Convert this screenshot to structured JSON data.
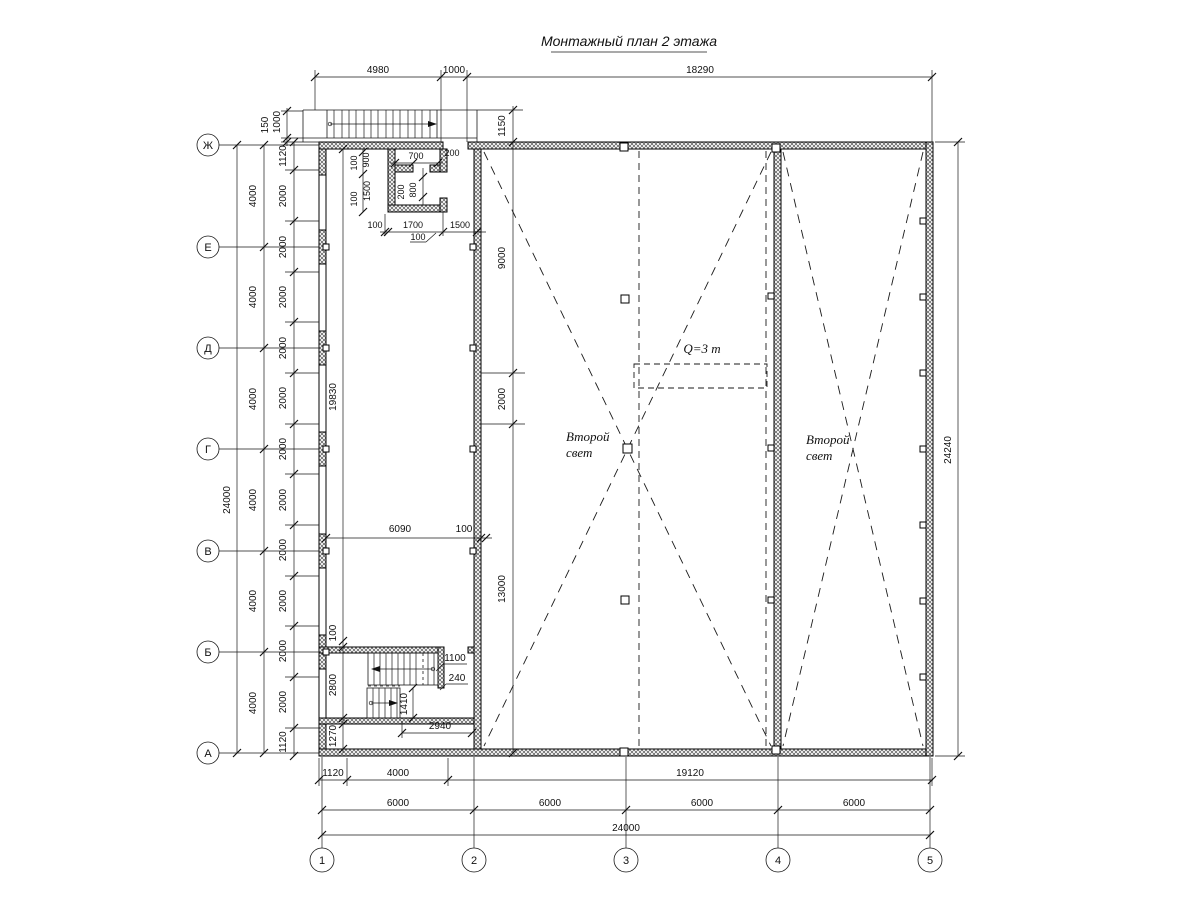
{
  "title": "Монтажный план 2 этажа",
  "grid": {
    "rows": [
      "Ж",
      "Е",
      "Д",
      "Г",
      "В",
      "Б",
      "А"
    ],
    "cols": [
      "1",
      "2",
      "3",
      "4",
      "5"
    ]
  },
  "dims": {
    "top": [
      "4980",
      "1000",
      "18290"
    ],
    "stair_top": {
      "gap": "150",
      "width": "1000"
    },
    "left": {
      "total": "24000",
      "bays": [
        "4000",
        "4000",
        "4000",
        "4000",
        "4000",
        "4000"
      ],
      "fine": [
        "1120",
        "2000",
        "2000",
        "2000",
        "2000",
        "2000",
        "2000",
        "2000",
        "2000",
        "2000",
        "2000",
        "2000",
        "1120"
      ]
    },
    "right_total": "24240",
    "hall_vertical": [
      "1150",
      "9000",
      "2000",
      "13000"
    ],
    "corridor": {
      "height": "19830",
      "width": "6090",
      "wall": "100"
    },
    "room_top": {
      "v1": "100",
      "v2": "900",
      "h1": "700",
      "h2": "200",
      "v3": "100",
      "v4": "1500",
      "d1": "200",
      "d2": "800",
      "b1": "100",
      "b2": "1700",
      "b3": "1500",
      "b4": "100"
    },
    "stair_room": {
      "off": "100",
      "height": "2800",
      "strip": "1270",
      "landing": "1100",
      "gap": "240",
      "flight": "1410",
      "run": "2940"
    },
    "bottom": {
      "row1": [
        "1120",
        "4000",
        "19120"
      ],
      "row2": [
        "6000",
        "6000",
        "6000",
        "6000"
      ],
      "total": "24000"
    }
  },
  "annotations": {
    "crane_load": "Q=3 т",
    "second_light": {
      "line1": "Второй",
      "line2": "свет"
    }
  },
  "colors": {
    "line": "#1a1a1a",
    "paper": "#ffffff"
  }
}
